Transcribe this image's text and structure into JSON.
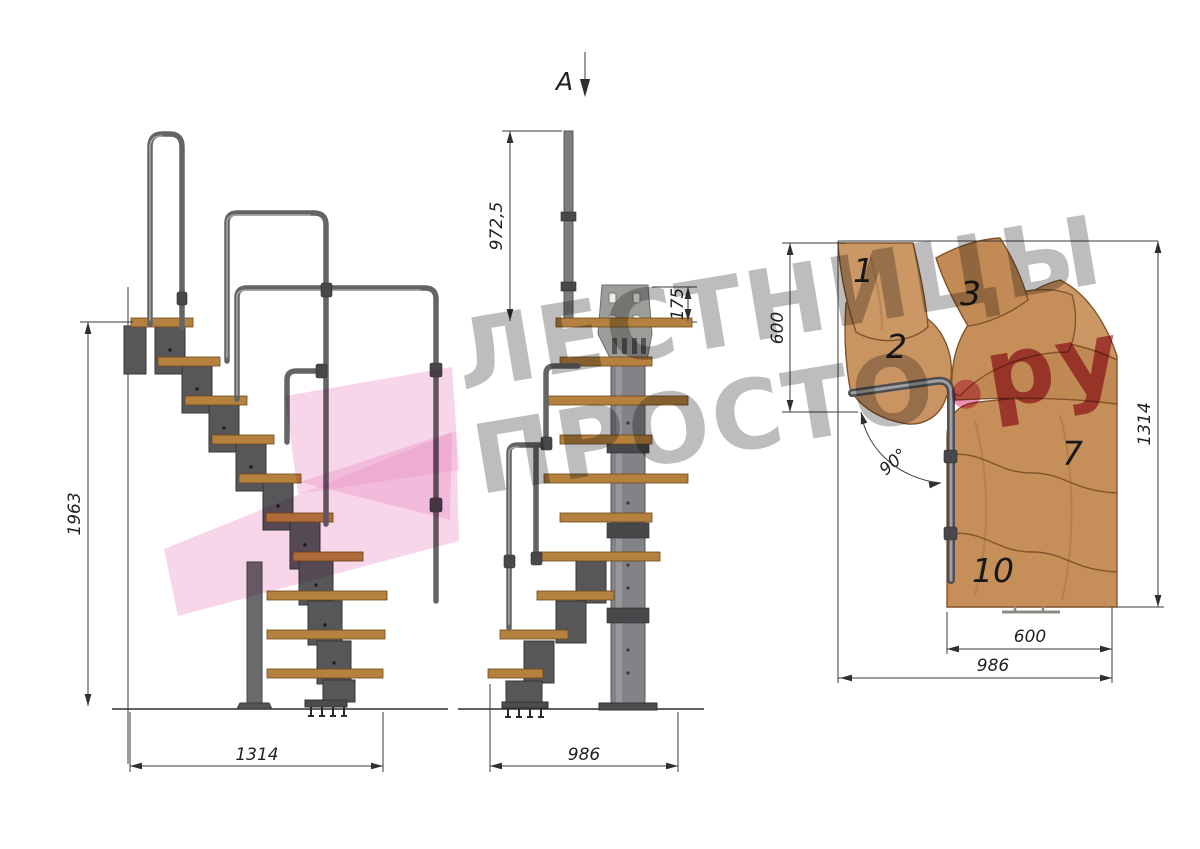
{
  "drawing": {
    "section_label": "A",
    "views": {
      "side": {
        "height": "1963",
        "width": "1314"
      },
      "front": {
        "handrail_height": "972,5",
        "plate_offset": "175",
        "width": "986"
      },
      "plan": {
        "landing_depth": "600",
        "total_depth": "1314",
        "flight_width": "600",
        "total_width": "986",
        "turn_angle": "90°",
        "step_numbers": {
          "s1": "1",
          "s2": "2",
          "s3": "3",
          "s7": "7",
          "s10": "10"
        }
      }
    }
  },
  "watermark": {
    "line1": "ЛЕСТНИЦЫ",
    "line2_word": "ПРОСТО",
    "line2_dot": ".",
    "line2_suffix": "ру"
  },
  "colors": {
    "wood_plan": "#c7925d",
    "wood_side": "#b4813f",
    "metal_module": "#57575a",
    "handrail": "#646467",
    "dimension_line": "#3a3a3a",
    "watermark_gray": "#808080",
    "watermark_pink": "#f2aed6",
    "watermark_red": "#b73650"
  }
}
